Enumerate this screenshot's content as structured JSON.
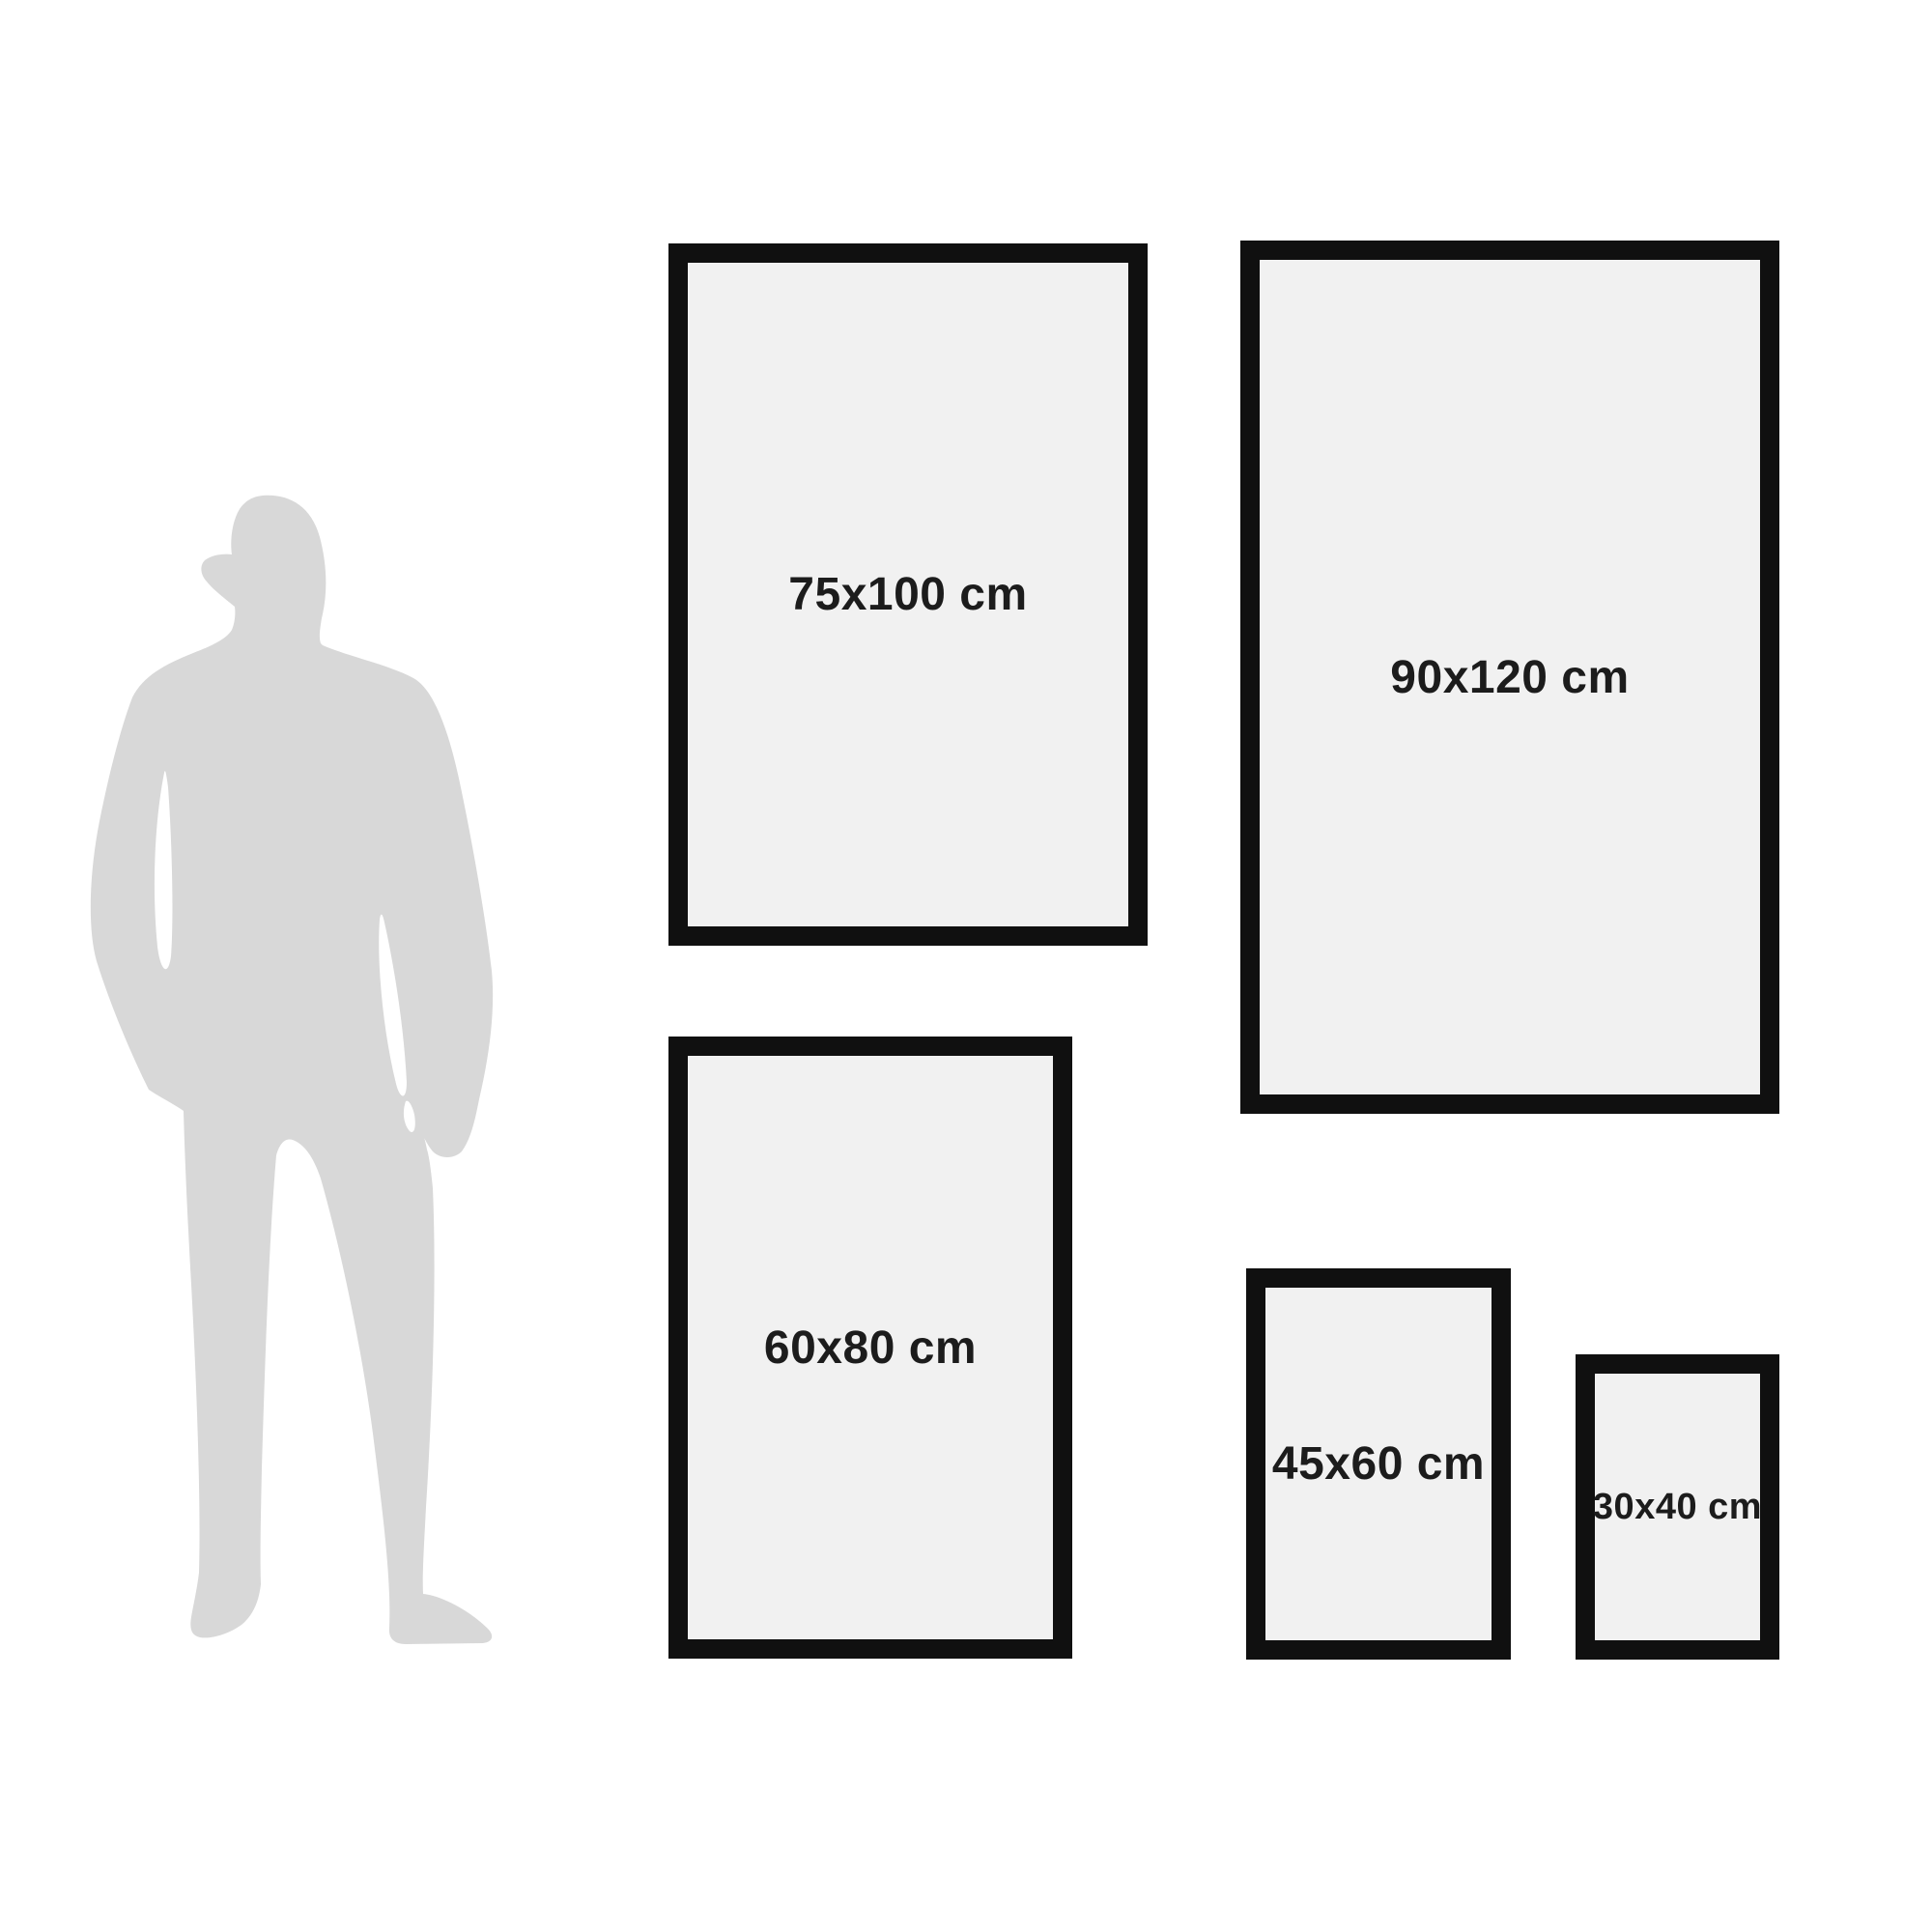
{
  "colors": {
    "background": "#ffffff",
    "frame_border": "#101010",
    "frame_fill": "#f1f1f1",
    "silhouette": "#d8d8d8",
    "label_text": "#1c1c1c"
  },
  "frames": [
    {
      "label": "75x100 cm"
    },
    {
      "label": "90x120 cm"
    },
    {
      "label": "60x80 cm"
    },
    {
      "label": "45x60 cm"
    },
    {
      "label": "30x40 cm"
    }
  ]
}
